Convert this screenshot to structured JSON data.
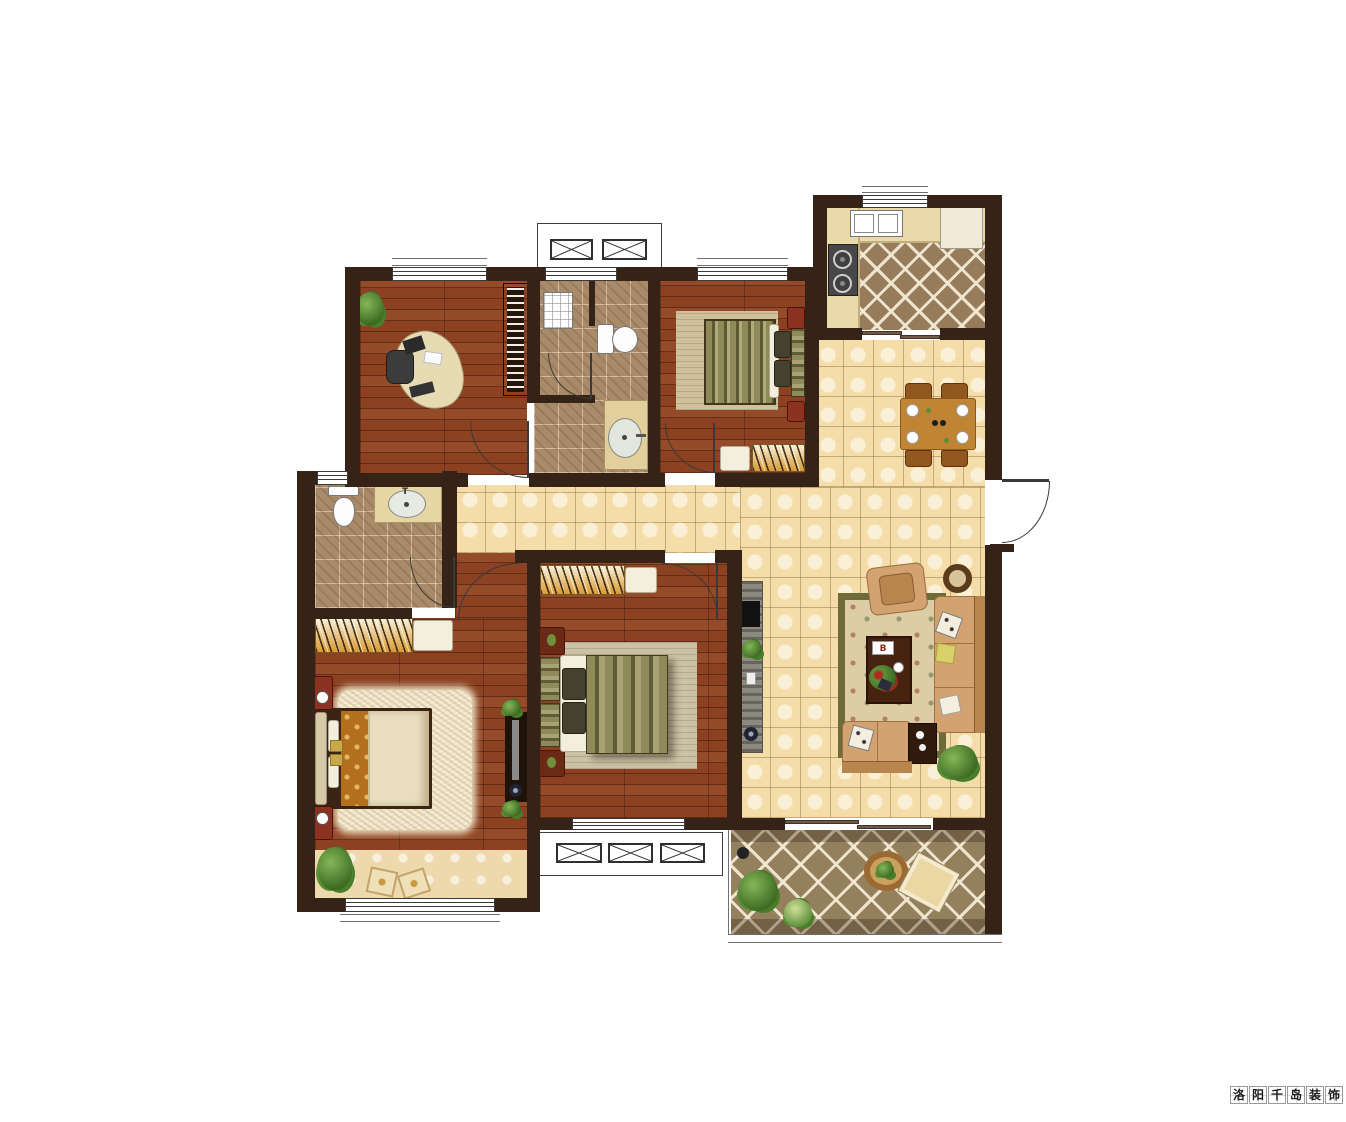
{
  "watermark": {
    "text": "洛阳千岛装饰",
    "chars": [
      "洛",
      "阳",
      "千",
      "岛",
      "装",
      "饰"
    ]
  },
  "labels": {
    "sink_tap": "T",
    "magazine": "B"
  },
  "palette": {
    "wall": "#352318",
    "line": "#3a3a3a",
    "wood": "#8c4222",
    "tile": "#f4dda8",
    "bath_tile": "#a98a69",
    "kitchen_floor": "#977c5b",
    "balcony_floor": "#95805e",
    "counter": "#ead9a9",
    "sofa": "#d2a271",
    "rug_field": "#dccda6",
    "rug_border": "#6e6a39",
    "red_cabinet": "#8c3220",
    "olive_bed": "#8f8a5a",
    "orange_quilt": "#b36f1e",
    "shag_rug": "#efe3c8",
    "wood_table": "#c08435",
    "plant_green": "#4a7d2c",
    "tv_gray": "#8b8a80"
  },
  "rooms": [
    {
      "name": "study",
      "furniture": [
        "desk",
        "office-chair",
        "bookshelf",
        "plant"
      ]
    },
    {
      "name": "bathroom-main",
      "furniture": [
        "shower-tray",
        "toilet",
        "wash-basin"
      ]
    },
    {
      "name": "bedroom-secondary",
      "furniture": [
        "double-bed",
        "rug",
        "nightstand",
        "nightstand",
        "wardrobe"
      ]
    },
    {
      "name": "kitchen",
      "furniture": [
        "double-sink",
        "counter",
        "gas-stove",
        "refrigerator"
      ]
    },
    {
      "name": "dining-area",
      "furniture": [
        "dining-table",
        "chair",
        "chair",
        "chair",
        "chair"
      ]
    },
    {
      "name": "living-room",
      "furniture": [
        "tv-cabinet",
        "armchair",
        "round-side-table",
        "rug",
        "coffee-table",
        "sofa",
        "loveseat",
        "side-table",
        "plant"
      ]
    },
    {
      "name": "master-bathroom",
      "furniture": [
        "toilet",
        "wash-basin"
      ]
    },
    {
      "name": "master-bedroom",
      "furniture": [
        "wardrobe",
        "double-bed",
        "shag-rug",
        "nightstand",
        "nightstand",
        "tv-unit",
        "bay-window-seat"
      ]
    },
    {
      "name": "bedroom-center",
      "furniture": [
        "wardrobe",
        "double-bed",
        "rug",
        "nightstand",
        "nightstand"
      ]
    },
    {
      "name": "balcony",
      "furniture": [
        "round-table",
        "floor-cushion",
        "shrub",
        "shrub"
      ]
    }
  ]
}
